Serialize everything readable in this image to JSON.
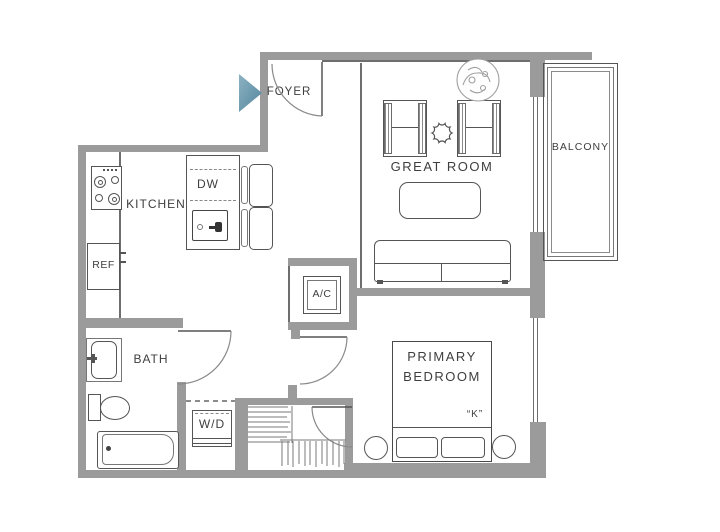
{
  "plan": {
    "type": "apartment-floor-plan",
    "rooms": {
      "foyer": "FOYER",
      "kitchen": "KITCHEN",
      "great_room": "GREAT ROOM",
      "balcony": "BALCONY",
      "bath": "BATH",
      "primary_bedroom": [
        "PRIMARY",
        "BEDROOM"
      ]
    },
    "fixtures": {
      "dishwasher": "DW",
      "refrigerator": "REF",
      "washer_dryer": "W/D",
      "air_conditioner": "A/C",
      "bed_size": "“K”"
    },
    "icons": {
      "entry_arrow": "right-pointing-triangle",
      "plant": "scribbled-circle",
      "side_table": "scalloped-circle"
    },
    "colors": {
      "wall": "#9b9b9b",
      "line": "#555555",
      "text": "#3e3e3e",
      "entry_arrow": "#6a9ab0",
      "background": "#ffffff"
    }
  }
}
